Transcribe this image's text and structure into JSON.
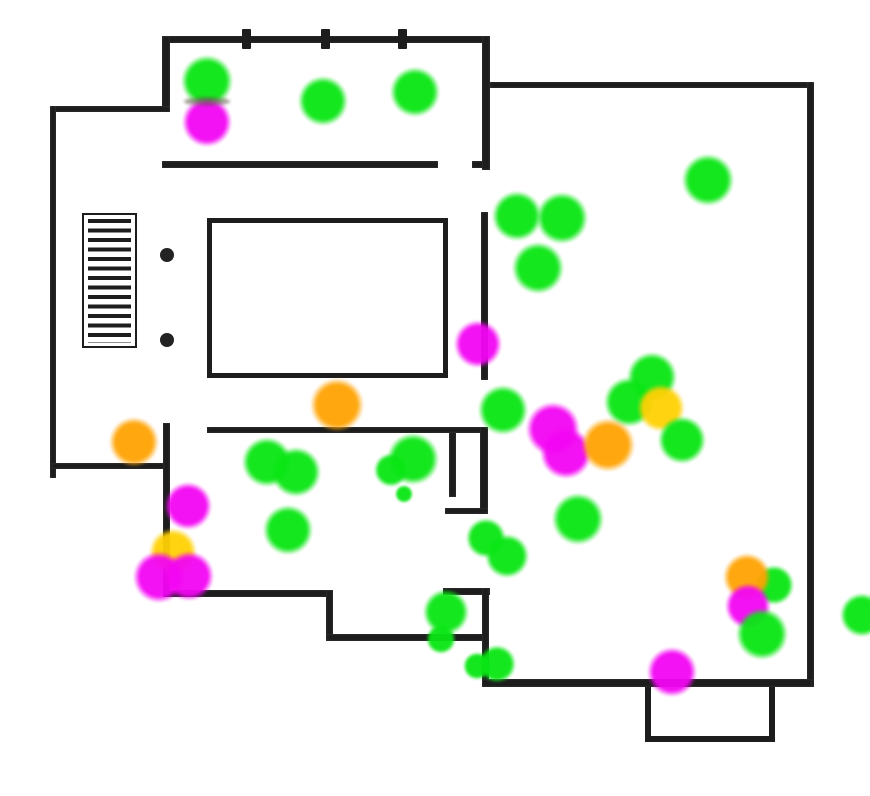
{
  "canvas": {
    "width": 870,
    "height": 796,
    "background": "#ffffff"
  },
  "palette": {
    "wall": "#1d1d1d",
    "dot": "#232323",
    "green": "#09e614",
    "magenta": "#f306f3",
    "orange": "#ffa303",
    "yellow": "#ffd104"
  },
  "walls": [
    {
      "name": "top-room-top-wall",
      "x": 162,
      "y": 36,
      "w": 328,
      "h": 7
    },
    {
      "name": "top-room-left-wall",
      "x": 162,
      "y": 36,
      "w": 8,
      "h": 76
    },
    {
      "name": "porch-top-wall",
      "x": 52,
      "y": 106,
      "w": 118,
      "h": 6
    },
    {
      "name": "left-outer-wall",
      "x": 50,
      "y": 106,
      "w": 6,
      "h": 372
    },
    {
      "name": "top-room-bottom-wall",
      "x": 162,
      "y": 161,
      "w": 276,
      "h": 7
    },
    {
      "name": "top-room-bottom-stub",
      "x": 472,
      "y": 161,
      "w": 18,
      "h": 7
    },
    {
      "name": "center-wall-upper",
      "x": 482,
      "y": 36,
      "w": 8,
      "h": 134
    },
    {
      "name": "right-room-top-wall",
      "x": 490,
      "y": 82,
      "w": 322,
      "h": 6
    },
    {
      "name": "right-outer-wall",
      "x": 807,
      "y": 82,
      "w": 7,
      "h": 605
    },
    {
      "name": "center-wall-mid",
      "x": 481,
      "y": 212,
      "w": 7,
      "h": 168
    },
    {
      "name": "below-bed-wall",
      "x": 207,
      "y": 427,
      "w": 281,
      "h": 6
    },
    {
      "name": "center-wall-lower",
      "x": 480,
      "y": 427,
      "w": 8,
      "h": 86
    },
    {
      "name": "door-jamb-inner",
      "x": 449,
      "y": 432,
      "w": 7,
      "h": 65
    },
    {
      "name": "door-ledge",
      "x": 445,
      "y": 508,
      "w": 43,
      "h": 6
    },
    {
      "name": "left-room-divider",
      "x": 52,
      "y": 463,
      "w": 118,
      "h": 6
    },
    {
      "name": "left-mid-vertical-wall",
      "x": 163,
      "y": 423,
      "w": 7,
      "h": 174
    },
    {
      "name": "lower-left-wall",
      "x": 163,
      "y": 590,
      "w": 170,
      "h": 7
    },
    {
      "name": "lower-left-jog",
      "x": 326,
      "y": 590,
      "w": 7,
      "h": 50
    },
    {
      "name": "lower-center-wall",
      "x": 326,
      "y": 634,
      "w": 162,
      "h": 7
    },
    {
      "name": "vestibule-wall",
      "x": 443,
      "y": 588,
      "w": 47,
      "h": 7
    },
    {
      "name": "center-wall-bottom",
      "x": 482,
      "y": 588,
      "w": 7,
      "h": 97
    },
    {
      "name": "bottom-outer-wall",
      "x": 482,
      "y": 679,
      "w": 330,
      "h": 8
    }
  ],
  "posts": [
    {
      "name": "fence-post-1",
      "x": 242,
      "y": 29,
      "w": 9,
      "h": 20
    },
    {
      "name": "fence-post-2",
      "x": 321,
      "y": 29,
      "w": 9,
      "h": 20
    },
    {
      "name": "fence-post-3",
      "x": 398,
      "y": 29,
      "w": 9,
      "h": 20
    }
  ],
  "dots": [
    {
      "name": "column-dot-1",
      "cx": 167,
      "cy": 255,
      "r": 7
    },
    {
      "name": "column-dot-2",
      "cx": 167,
      "cy": 340,
      "r": 7
    }
  ],
  "furniture": {
    "stairs": {
      "x": 82,
      "y": 213,
      "w": 55,
      "h": 135
    },
    "bed": {
      "x": 207,
      "y": 218,
      "w": 241,
      "h": 160
    },
    "bay": {
      "x": 645,
      "y": 687,
      "w": 130,
      "h": 55
    }
  },
  "seams": [
    {
      "name": "green-magenta-seam",
      "x": 184,
      "y": 97,
      "w": 46,
      "h": 9
    }
  ],
  "blobs": [
    {
      "color": "green",
      "x": 207,
      "y": 81,
      "r": 26
    },
    {
      "color": "magenta",
      "x": 207,
      "y": 122,
      "r": 25
    },
    {
      "color": "green",
      "x": 323,
      "y": 101,
      "r": 25
    },
    {
      "color": "green",
      "x": 415,
      "y": 92,
      "r": 25
    },
    {
      "color": "green",
      "x": 708,
      "y": 180,
      "r": 26
    },
    {
      "color": "green",
      "x": 517,
      "y": 216,
      "r": 25
    },
    {
      "color": "green",
      "x": 562,
      "y": 218,
      "r": 26
    },
    {
      "color": "green",
      "x": 538,
      "y": 268,
      "r": 26
    },
    {
      "color": "magenta",
      "x": 478,
      "y": 344,
      "r": 24
    },
    {
      "color": "green",
      "x": 503,
      "y": 410,
      "r": 25
    },
    {
      "color": "green",
      "x": 652,
      "y": 377,
      "r": 25
    },
    {
      "color": "green",
      "x": 629,
      "y": 402,
      "r": 25
    },
    {
      "color": "yellow",
      "x": 661,
      "y": 408,
      "r": 24
    },
    {
      "color": "green",
      "x": 682,
      "y": 440,
      "r": 24
    },
    {
      "color": "magenta",
      "x": 553,
      "y": 429,
      "r": 27
    },
    {
      "color": "magenta",
      "x": 566,
      "y": 453,
      "r": 26
    },
    {
      "color": "orange",
      "x": 608,
      "y": 445,
      "r": 27
    },
    {
      "color": "green",
      "x": 578,
      "y": 519,
      "r": 26
    },
    {
      "color": "green",
      "x": 486,
      "y": 538,
      "r": 20
    },
    {
      "color": "green",
      "x": 507,
      "y": 556,
      "r": 22
    },
    {
      "color": "green",
      "x": 446,
      "y": 612,
      "r": 23
    },
    {
      "color": "green",
      "x": 441,
      "y": 639,
      "r": 15
    },
    {
      "color": "green",
      "x": 477,
      "y": 666,
      "r": 14
    },
    {
      "color": "green",
      "x": 497,
      "y": 664,
      "r": 19
    },
    {
      "color": "magenta",
      "x": 672,
      "y": 672,
      "r": 25
    },
    {
      "color": "green",
      "x": 774,
      "y": 585,
      "r": 20
    },
    {
      "color": "orange",
      "x": 747,
      "y": 577,
      "r": 24
    },
    {
      "color": "magenta",
      "x": 748,
      "y": 606,
      "r": 23
    },
    {
      "color": "green",
      "x": 762,
      "y": 634,
      "r": 26
    },
    {
      "color": "green",
      "x": 862,
      "y": 615,
      "r": 22
    },
    {
      "color": "orange",
      "x": 134,
      "y": 442,
      "r": 25
    },
    {
      "color": "magenta",
      "x": 188,
      "y": 506,
      "r": 24
    },
    {
      "color": "yellow",
      "x": 173,
      "y": 552,
      "r": 24
    },
    {
      "color": "magenta",
      "x": 159,
      "y": 577,
      "r": 26
    },
    {
      "color": "magenta",
      "x": 189,
      "y": 576,
      "r": 25
    },
    {
      "color": "green",
      "x": 267,
      "y": 462,
      "r": 25
    },
    {
      "color": "green",
      "x": 296,
      "y": 472,
      "r": 25
    },
    {
      "color": "green",
      "x": 288,
      "y": 530,
      "r": 25
    },
    {
      "color": "orange",
      "x": 337,
      "y": 405,
      "r": 27
    },
    {
      "color": "green",
      "x": 413,
      "y": 459,
      "r": 26
    },
    {
      "color": "green",
      "x": 391,
      "y": 470,
      "r": 17
    },
    {
      "color": "green",
      "x": 404,
      "y": 494,
      "r": 9
    }
  ]
}
